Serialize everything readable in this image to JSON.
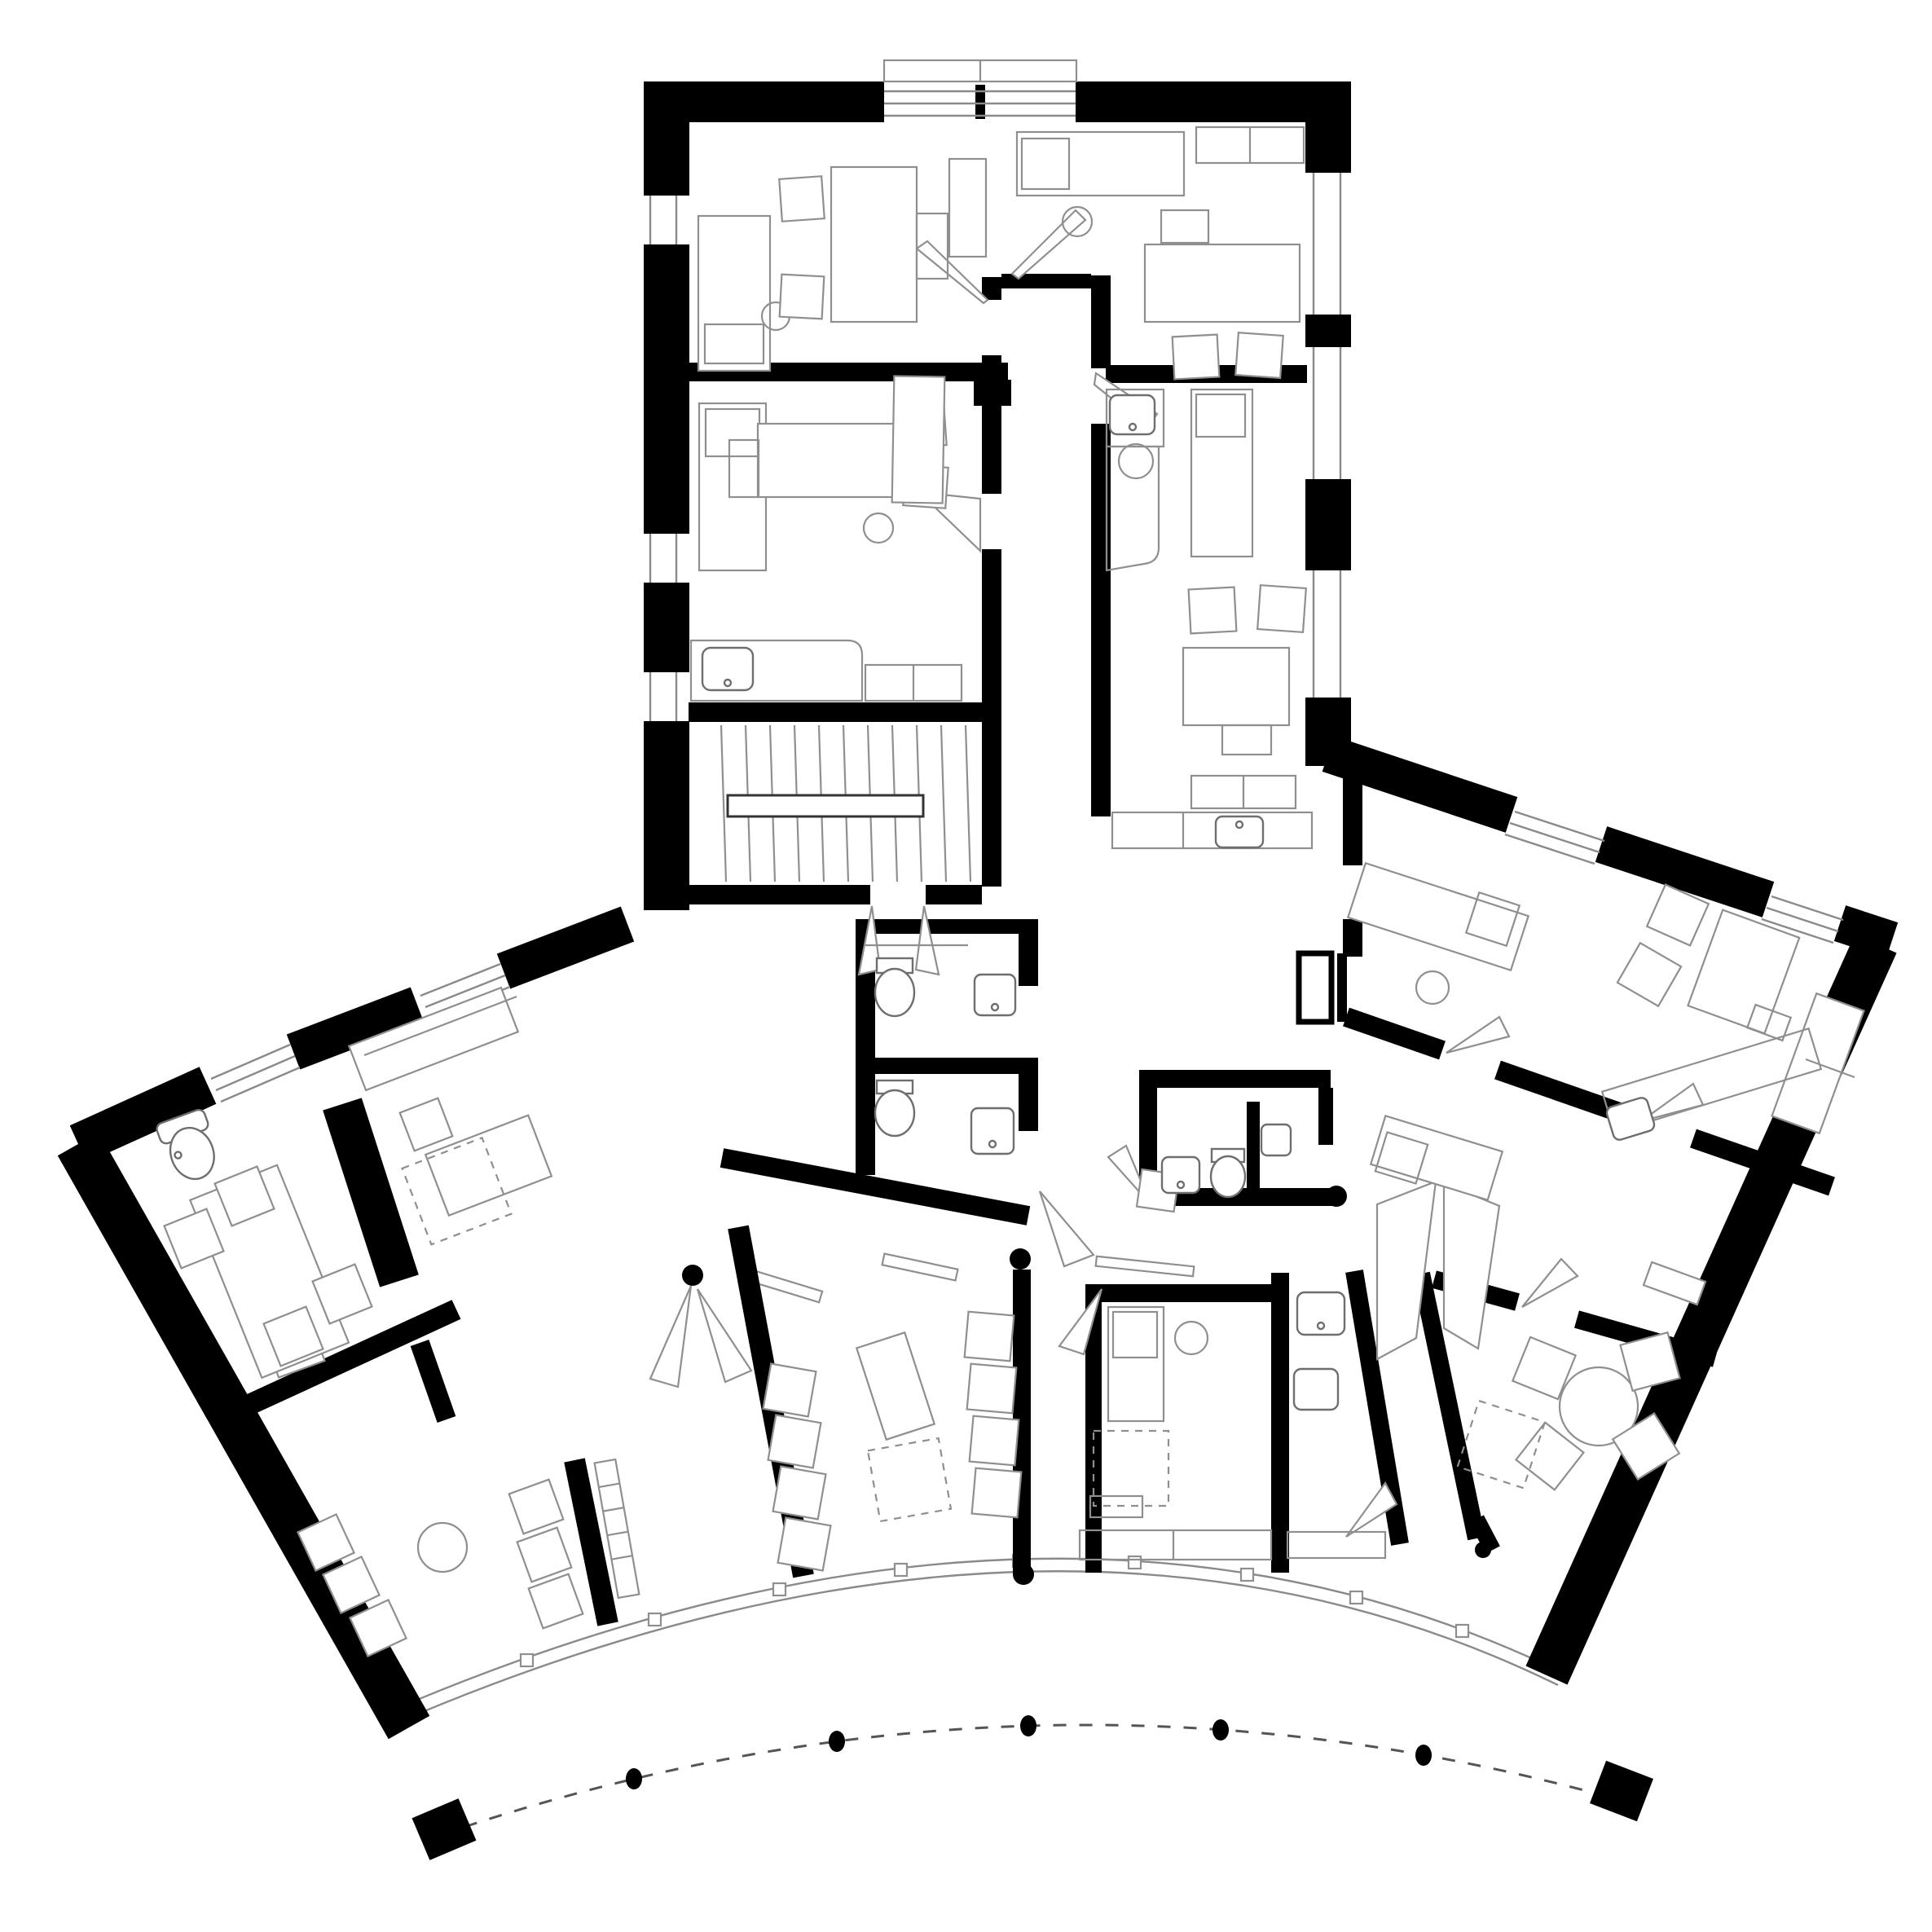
{
  "title": "Black-and-white architectural floor plan: rectangular north wing with staircase and central corridor joining a fan-shaped south wing, curved glazed facade and dashed colonnade arc with columns",
  "colors": {
    "background": "#ffffff",
    "wall": "#000000",
    "furniture_line": "#8f8f8f",
    "fixture_line": "#6e6e6e",
    "glazing_line": "#8a8a8a",
    "dashed_line": "#555555"
  },
  "counts": {
    "colonnade_dots": 5,
    "colonnade_end_blocks": 2,
    "interior_column_dots": 5,
    "stair_treads": 11
  }
}
